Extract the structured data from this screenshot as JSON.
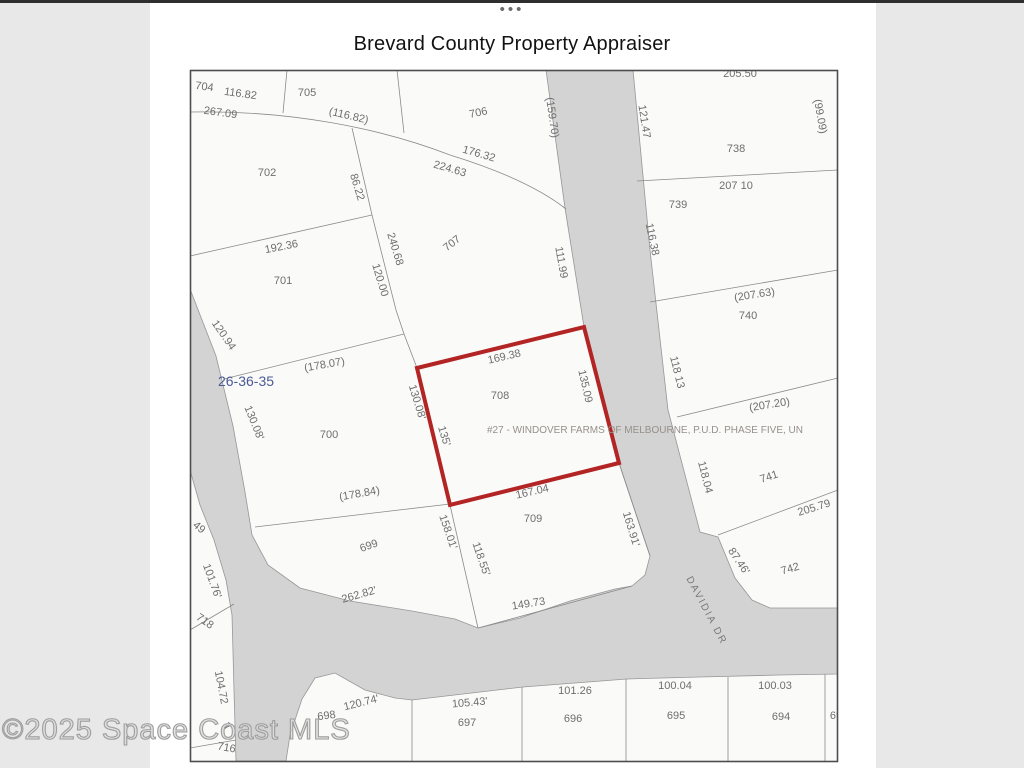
{
  "page": {
    "dots": "•••",
    "title": "Brevard County Property Appraiser",
    "watermark": "©2025 Space Coast MLS",
    "background": "#e8e8e8",
    "panel_background": "#ffffff"
  },
  "map": {
    "border_color": "#4d4d4d",
    "bg_color": "#fafaf9",
    "road_color": "#d3d3d3",
    "road_edge_color": "#979797",
    "line_color": "#8a8a8a",
    "label_color": "#6e6e6e",
    "section_label": "26-36-35",
    "selected_lot": "708",
    "subdivision_note": "#27 - WINDOVER FARMS OF MELBOURNE, P.U.D. PHASE FIVE, UN",
    "street_name": "DAVIDIA DR",
    "red_parcel": {
      "points": "417,368 584,327 619,463 450,505",
      "color": "#b32424",
      "stroke_width": 4
    },
    "roads": [
      "M546,70 L633,70 L650,250 L668,410 L700,532 L718,537 L735,578 L752,600 L770,608 L838,608 L838,674 L780,675 L700,677 L627,679 L523,687 L412,700 L395,698 L365,690 L335,673 L315,678 L302,699 L290,735 L286,761 L236,761 L234,690 L232,615 L226,580 L214,540 L200,505 L190,470 L190,289 L216,356 L233,426 L245,492 L252,535 L268,565 L300,588 L350,601 L412,611 L455,619 L478,628 L520,618 L570,601 L615,589 L632,586 L645,575 L650,556 L619,463 L584,327 L565,208 Z"
    ],
    "lines": [
      "M287,70 L283,113",
      "M397,70 L404,133",
      "M352,128 L372,215 L396,310 L404,334",
      "M190,256 L372,215",
      "M224,379 L404,334",
      "M404,334 L417,368",
      "M450,505 L478,628",
      "M255,527 L450,504",
      "M478,628 L632,586",
      "M619,463 L650,556",
      "M637,181 L838,170",
      "M650,302 L838,270",
      "M677,417 L838,378",
      "M718,535 L838,490",
      "M412,700 L412,761",
      "M522,687 L522,761",
      "M626,679 L626,761",
      "M728,677 L728,761",
      "M825,674 L825,761",
      "M190,630 L234,604",
      "M190,748 L236,740",
      "M190,112 C290,110 380,128 450,155 C505,172 542,190 566,209"
    ],
    "labels": [
      {
        "t": "704",
        "x": 204,
        "y": 90,
        "r": 8,
        "s": 11
      },
      {
        "t": "116.82",
        "x": 240,
        "y": 97,
        "r": 8,
        "s": 11
      },
      {
        "t": "267.09",
        "x": 220,
        "y": 116,
        "r": 8,
        "s": 11
      },
      {
        "t": "705",
        "x": 307,
        "y": 96,
        "r": 0,
        "s": 11
      },
      {
        "t": "(116.82)",
        "x": 348,
        "y": 119,
        "r": 13,
        "s": 11
      },
      {
        "t": "706",
        "x": 479,
        "y": 116,
        "r": -12,
        "s": 11
      },
      {
        "t": "176.32",
        "x": 478,
        "y": 157,
        "r": 16,
        "s": 11
      },
      {
        "t": "224.63",
        "x": 449,
        "y": 172,
        "r": 16,
        "s": 11
      },
      {
        "t": "(159.70)",
        "x": 549,
        "y": 118,
        "r": 82,
        "s": 11
      },
      {
        "t": "121.47",
        "x": 641,
        "y": 122,
        "r": 81,
        "s": 11
      },
      {
        "t": "205.50",
        "x": 740,
        "y": 77,
        "r": 0,
        "s": 11
      },
      {
        "t": "(99.09)",
        "x": 817,
        "y": 117,
        "r": 80,
        "s": 11
      },
      {
        "t": "738",
        "x": 736,
        "y": 152,
        "r": 0,
        "s": 11
      },
      {
        "t": "207 10",
        "x": 736,
        "y": 189,
        "r": 0,
        "s": 11
      },
      {
        "t": "739",
        "x": 678,
        "y": 208,
        "r": 0,
        "s": 11
      },
      {
        "t": "116.38",
        "x": 649,
        "y": 240,
        "r": 78,
        "s": 11
      },
      {
        "t": "111.99",
        "x": 558,
        "y": 263,
        "r": 80,
        "s": 11
      },
      {
        "t": "702",
        "x": 267,
        "y": 176,
        "r": 0,
        "s": 11
      },
      {
        "t": "86.22",
        "x": 354,
        "y": 188,
        "r": 73,
        "s": 11
      },
      {
        "t": "192.36",
        "x": 282,
        "y": 250,
        "r": -11,
        "s": 11
      },
      {
        "t": "701",
        "x": 283,
        "y": 284,
        "r": 0,
        "s": 11
      },
      {
        "t": "240.68",
        "x": 392,
        "y": 250,
        "r": 73,
        "s": 11
      },
      {
        "t": "120.00",
        "x": 377,
        "y": 281,
        "r": 73,
        "s": 11
      },
      {
        "t": "707",
        "x": 454,
        "y": 246,
        "r": -38,
        "s": 11
      },
      {
        "t": "120.94",
        "x": 221,
        "y": 337,
        "r": 55,
        "s": 11
      },
      {
        "t": "26-36-35",
        "x": 246,
        "y": 386,
        "r": 0,
        "s": 14,
        "c": "#4a5b96"
      },
      {
        "t": "(178.07)",
        "x": 325,
        "y": 368,
        "r": -10,
        "s": 11
      },
      {
        "t": "130.08'",
        "x": 251,
        "y": 424,
        "r": 68,
        "s": 11
      },
      {
        "t": "700",
        "x": 329,
        "y": 438,
        "r": 0,
        "s": 11
      },
      {
        "t": "(178.84)",
        "x": 360,
        "y": 497,
        "r": -10,
        "s": 11
      },
      {
        "t": "(207.63)",
        "x": 755,
        "y": 298,
        "r": -9,
        "s": 11
      },
      {
        "t": "740",
        "x": 748,
        "y": 319,
        "r": 0,
        "s": 11
      },
      {
        "t": "118 13",
        "x": 674,
        "y": 373,
        "r": 76,
        "s": 11
      },
      {
        "t": "(207.20)",
        "x": 770,
        "y": 408,
        "r": -9,
        "s": 11
      },
      {
        "t": "130.08'",
        "x": 414,
        "y": 403,
        "r": 73,
        "s": 11
      },
      {
        "t": "135'",
        "x": 441,
        "y": 437,
        "r": 73,
        "s": 11
      },
      {
        "t": "169.38",
        "x": 505,
        "y": 360,
        "r": -13,
        "s": 11
      },
      {
        "t": "708",
        "x": 500,
        "y": 399,
        "r": 0,
        "s": 11
      },
      {
        "t": "135.09",
        "x": 582,
        "y": 387,
        "r": 77,
        "s": 11
      },
      {
        "t": "#27 - WINDOVER FARMS OF MELBOURNE, P.U.D. PHASE FIVE, UN",
        "x": 645,
        "y": 433,
        "r": 0,
        "s": 10,
        "c": "#97908a"
      },
      {
        "t": "167.04",
        "x": 533,
        "y": 495,
        "r": -13,
        "s": 11
      },
      {
        "t": "709",
        "x": 533,
        "y": 522,
        "r": 0,
        "s": 11
      },
      {
        "t": "163.91'",
        "x": 628,
        "y": 530,
        "r": 73,
        "s": 11
      },
      {
        "t": "118.04",
        "x": 702,
        "y": 478,
        "r": 76,
        "s": 11
      },
      {
        "t": "741",
        "x": 770,
        "y": 480,
        "r": -18,
        "s": 11
      },
      {
        "t": "205.79",
        "x": 815,
        "y": 511,
        "r": -17,
        "s": 11
      },
      {
        "t": "87.46'",
        "x": 736,
        "y": 563,
        "r": 56,
        "s": 11
      },
      {
        "t": "742",
        "x": 791,
        "y": 572,
        "r": -16,
        "s": 11
      },
      {
        "t": "158.01'",
        "x": 445,
        "y": 533,
        "r": 71,
        "s": 11
      },
      {
        "t": "118.55'",
        "x": 478,
        "y": 560,
        "r": 71,
        "s": 11
      },
      {
        "t": "699",
        "x": 370,
        "y": 549,
        "r": -20,
        "s": 11
      },
      {
        "t": "262.82'",
        "x": 360,
        "y": 598,
        "r": -16,
        "s": 11
      },
      {
        "t": "149.73",
        "x": 529,
        "y": 607,
        "r": -9,
        "s": 11
      },
      {
        "t": "DAVIDIA DR",
        "x": 704,
        "y": 612,
        "r": 62,
        "s": 10,
        "c": "#787878",
        "ls": 2
      },
      {
        "t": "49",
        "x": 197,
        "y": 530,
        "r": 40,
        "s": 11
      },
      {
        "t": "101.76'",
        "x": 209,
        "y": 582,
        "r": 70,
        "s": 11
      },
      {
        "t": "718",
        "x": 203,
        "y": 624,
        "r": 35,
        "s": 11
      },
      {
        "t": "104.72",
        "x": 218,
        "y": 688,
        "r": 79,
        "s": 11
      },
      {
        "t": "7",
        "x": 225,
        "y": 729,
        "r": 45,
        "s": 11
      },
      {
        "t": "716",
        "x": 226,
        "y": 751,
        "r": 10,
        "s": 11
      },
      {
        "t": "698",
        "x": 327,
        "y": 719,
        "r": -8,
        "s": 11
      },
      {
        "t": "120.74'",
        "x": 362,
        "y": 706,
        "r": -14,
        "s": 11
      },
      {
        "t": "697",
        "x": 467,
        "y": 726,
        "r": 0,
        "s": 11
      },
      {
        "t": "105.43'",
        "x": 470,
        "y": 706,
        "r": -5,
        "s": 11
      },
      {
        "t": "696",
        "x": 573,
        "y": 722,
        "r": 0,
        "s": 11
      },
      {
        "t": "101.26",
        "x": 575,
        "y": 694,
        "r": 0,
        "s": 11
      },
      {
        "t": "695",
        "x": 676,
        "y": 719,
        "r": 0,
        "s": 11
      },
      {
        "t": "100.04",
        "x": 675,
        "y": 689,
        "r": 0,
        "s": 11
      },
      {
        "t": "694",
        "x": 781,
        "y": 720,
        "r": 0,
        "s": 11
      },
      {
        "t": "100.03",
        "x": 775,
        "y": 689,
        "r": 0,
        "s": 11
      },
      {
        "t": "69",
        "x": 836,
        "y": 719,
        "r": 0,
        "s": 11
      },
      {
        "t": "34.3",
        "x": 841,
        "y": 222,
        "r": 76,
        "s": 10
      }
    ]
  }
}
